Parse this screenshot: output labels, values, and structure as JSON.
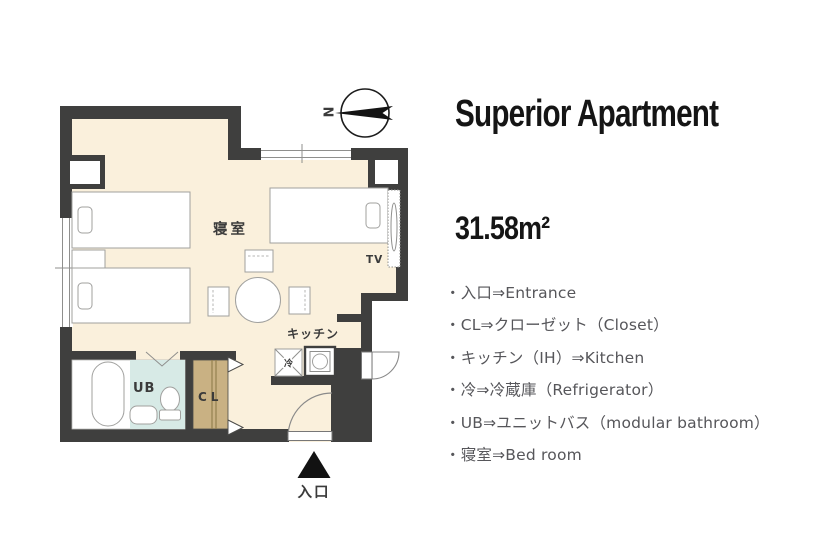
{
  "title": "Superior Apartment",
  "area": "31.58m²",
  "legend": {
    "items": [
      "・入口⇒Entrance",
      "・CL⇒クローゼット（Closet）",
      "・キッチン（IH）⇒Kitchen",
      "・冷⇒冷蔵庫（Refrigerator）",
      "・UB⇒ユニットバス（modular bathroom）",
      "・寝室⇒Bed room"
    ]
  },
  "floorplan": {
    "compass": "N",
    "labels": {
      "bedroom": "寝室",
      "kitchen": "キッチン",
      "tv": "TV",
      "unit_bath": "UB",
      "closet": "CL",
      "refrigerator": "冷",
      "entrance": "入口"
    },
    "colors": {
      "wall": "#3f3f3e",
      "floor": "#faf0dc",
      "unit-bath": "#d7eae6",
      "closet-wood": "#c9b183"
    }
  }
}
